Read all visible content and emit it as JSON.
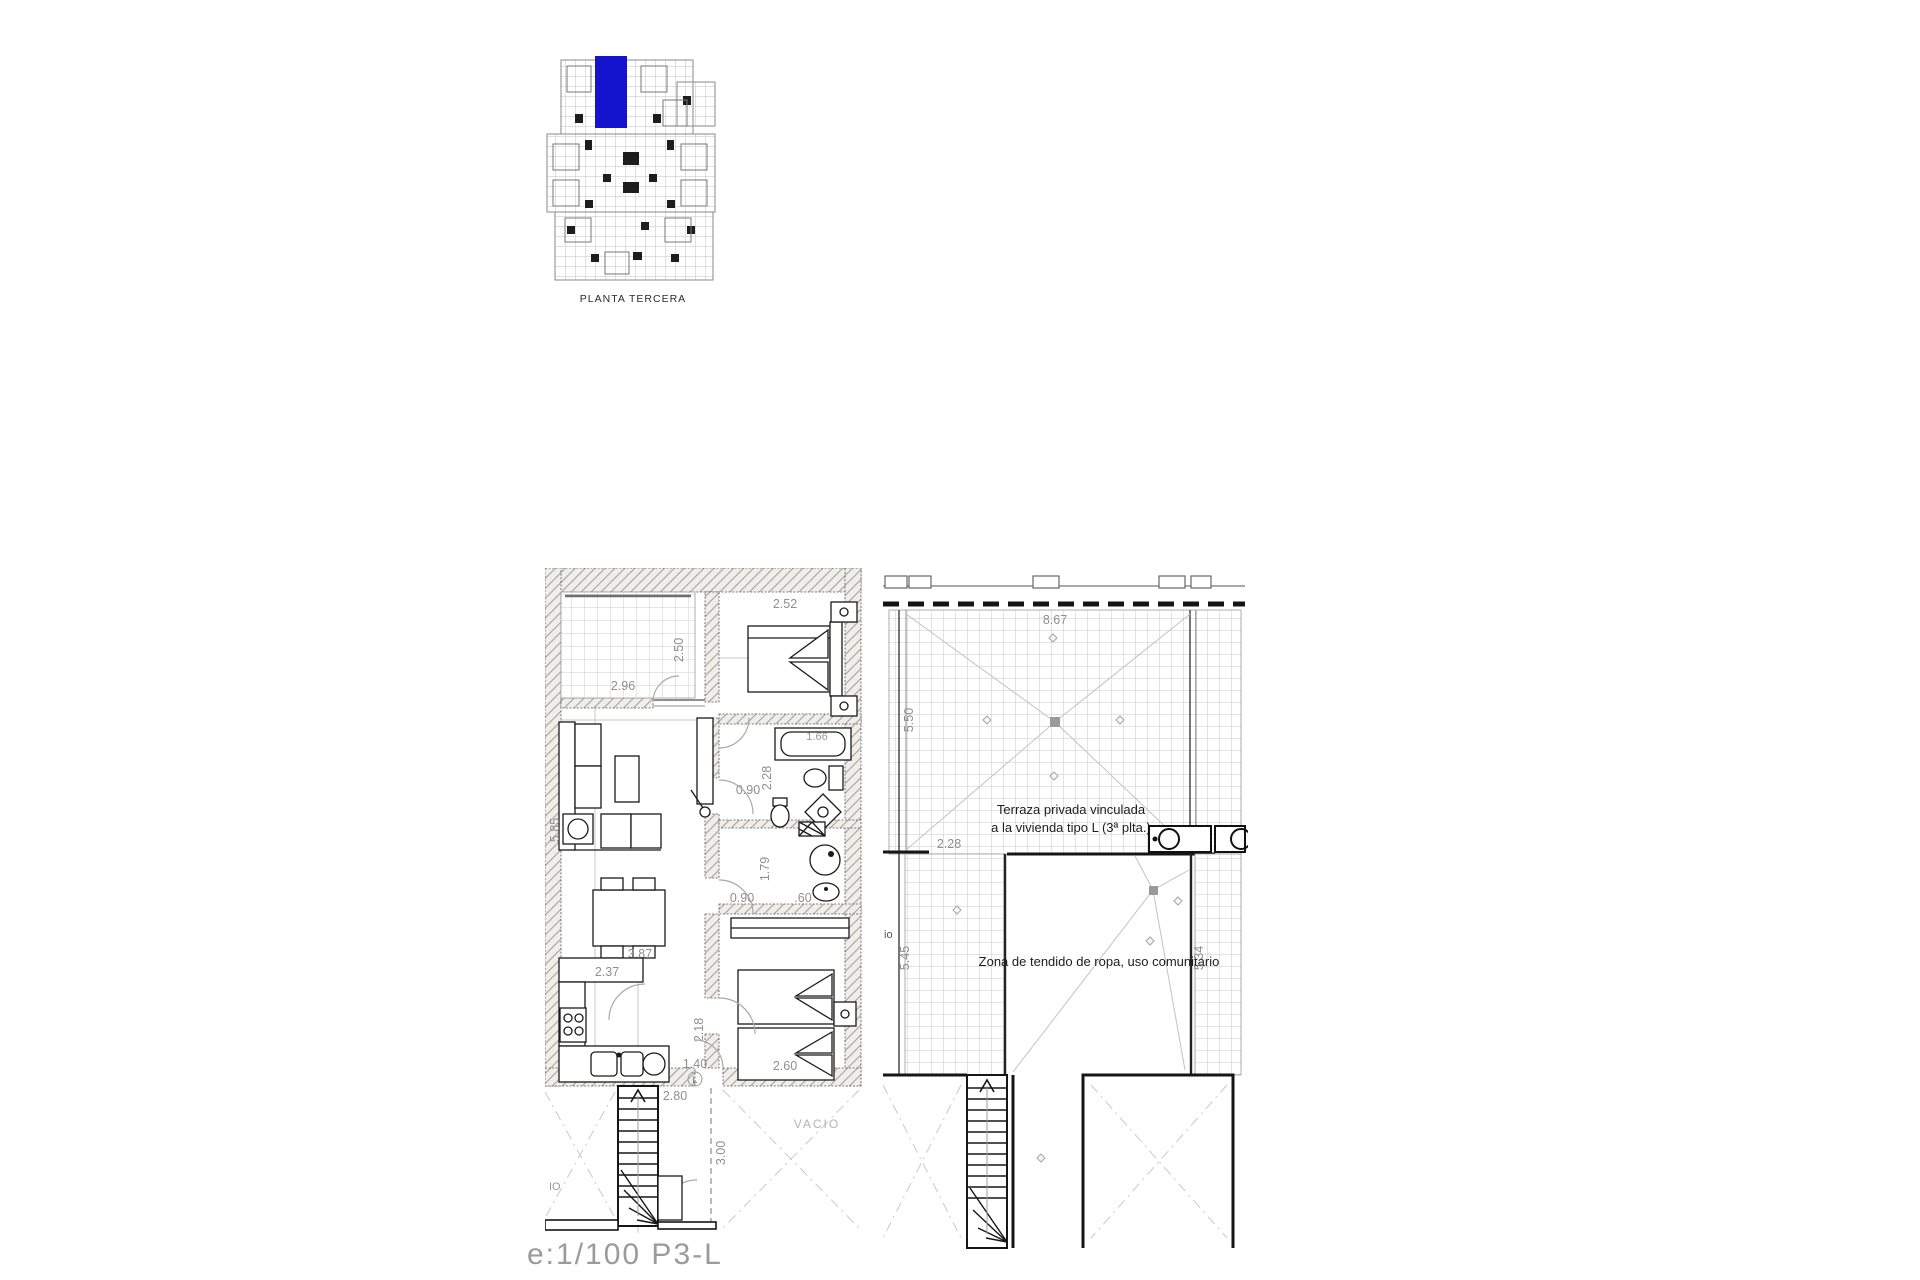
{
  "key_plan": {
    "label": "PLANTA TERCERA",
    "highlight_color": "#1414cf"
  },
  "scale": {
    "label": "e:1/100  P3-L"
  },
  "apartment": {
    "dims": {
      "terrace_w": "2.96",
      "terrace_d": "2.50",
      "bed1_w": "2.52",
      "tub": "1.66",
      "bath1_d": "2.28",
      "door_top": "0.90",
      "bath2_d": "1.79",
      "door_bottom": "0.90",
      "shower": ".60",
      "living_w": "3.87",
      "living_d": "5.85",
      "kitchen_w": "2.37",
      "hall_d": "2.18",
      "entry": "1.40",
      "bed2_w": "2.60",
      "stair_w": "2.80",
      "stair_d": "3.00"
    },
    "labels": {
      "void": "VACIO",
      "void_clip": "IO",
      "unit": "L"
    }
  },
  "terrace": {
    "texts": {
      "private_line1": "Terraza privada vinculada",
      "private_line2": "a la vivienda tipo L (3ª plta.)",
      "laundry": "Zona de tendido de ropa, uso comunitario",
      "clip": "io"
    },
    "dims": {
      "width": "8.67",
      "depth_upper": "5.50",
      "inner": "2.28",
      "depth_left": "5.45",
      "depth_right": "5.34"
    }
  }
}
